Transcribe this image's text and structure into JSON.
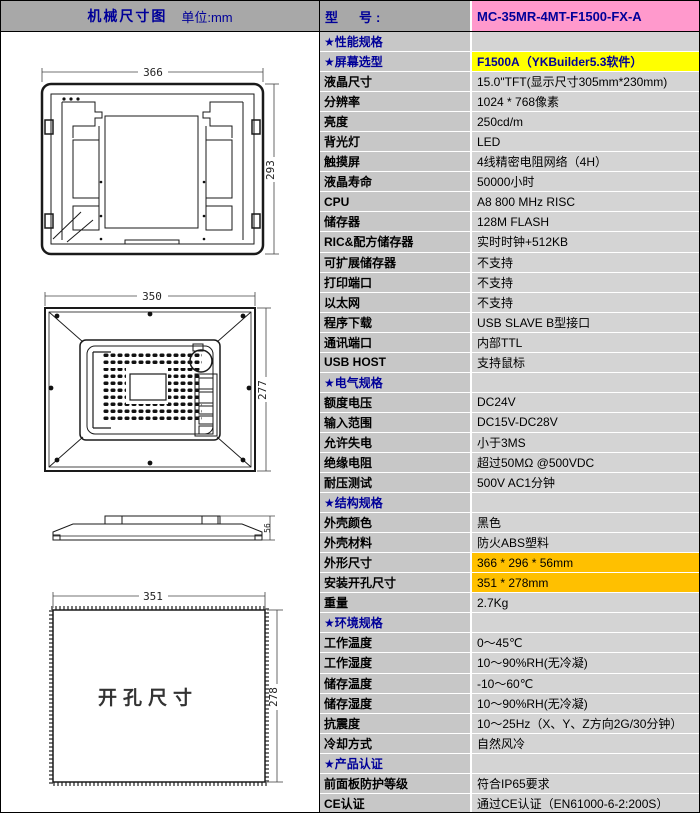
{
  "header": {
    "left_title": "机械尺寸图",
    "left_unit": "单位:mm",
    "model_label": "型　号:",
    "model_value": "MC-35MR-4MT-F1500-FX-A"
  },
  "drawings": {
    "front_view": {
      "width": "366",
      "height": "293"
    },
    "back_view": {
      "width": "350",
      "height": "277"
    },
    "side_view": {
      "depth": "56"
    },
    "cutout": {
      "width": "351",
      "height": "278",
      "label": "开孔尺寸"
    }
  },
  "colors": {
    "header_bg": "#a8a8a8",
    "model_bg": "#ff99cc",
    "label_bg": "#c7c7c7",
    "value_bg": "#d4d4d4",
    "highlight_yellow": "#ffff00",
    "highlight_orange": "#ffc000",
    "accent_blue": "#000099"
  },
  "table": {
    "rows": [
      {
        "type": "section",
        "label": "★性能规格",
        "value": ""
      },
      {
        "type": "yellow",
        "label": "★屏幕选型",
        "value": "F1500A（YKBuilder5.3软件）"
      },
      {
        "label": "液晶尺寸",
        "value": "15.0\"TFT(显示尺寸305mm*230mm)"
      },
      {
        "label": "分辨率",
        "value": "1024 * 768像素"
      },
      {
        "label": "亮度",
        "value": "250cd/m"
      },
      {
        "label": "背光灯",
        "value": "LED"
      },
      {
        "label": "触摸屏",
        "value": "4线精密电阻网络（4H）"
      },
      {
        "label": "液晶寿命",
        "value": "50000小时"
      },
      {
        "label": "CPU",
        "value": "A8 800 MHz RISC"
      },
      {
        "label": "储存器",
        "value": "128M FLASH"
      },
      {
        "label": "RIC&配方储存器",
        "value": "实时时钟+512KB"
      },
      {
        "label": "可扩展储存器",
        "value": "不支持"
      },
      {
        "label": "打印端口",
        "value": "不支持"
      },
      {
        "label": "以太网",
        "value": "不支持"
      },
      {
        "label": "程序下载",
        "value": "USB SLAVE B型接口"
      },
      {
        "label": "通讯端口",
        "value": "内部TTL"
      },
      {
        "label": "USB HOST",
        "value": "支持鼠标"
      },
      {
        "type": "section",
        "label": "★电气规格",
        "value": ""
      },
      {
        "label": "额度电压",
        "value": "DC24V"
      },
      {
        "label": "输入范围",
        "value": "DC15V-DC28V"
      },
      {
        "label": "允许失电",
        "value": "小于3MS"
      },
      {
        "label": "绝缘电阻",
        "value": "超过50MΩ @500VDC"
      },
      {
        "label": "耐压测试",
        "value": "500V AC1分钟"
      },
      {
        "type": "section",
        "label": "★结构规格",
        "value": ""
      },
      {
        "label": "外壳颜色",
        "value": "黑色"
      },
      {
        "label": "外壳材料",
        "value": "防火ABS塑料"
      },
      {
        "type": "orange",
        "label": "外形尺寸",
        "value": "366 * 296 * 56mm"
      },
      {
        "type": "orange",
        "label": "安装开孔尺寸",
        "value": "351 * 278mm"
      },
      {
        "label": "重量",
        "value": "2.7Kg"
      },
      {
        "type": "section",
        "label": "★环境规格",
        "value": ""
      },
      {
        "label": "工作温度",
        "value": "0～45℃"
      },
      {
        "label": "工作湿度",
        "value": "10～90%RH(无冷凝)"
      },
      {
        "label": "储存温度",
        "value": "-10～60℃"
      },
      {
        "label": "储存湿度",
        "value": "10～90%RH(无冷凝)"
      },
      {
        "label": "抗震度",
        "value": "10～25Hz（X、Y、Z方向2G/30分钟）"
      },
      {
        "label": "冷却方式",
        "value": "自然风冷"
      },
      {
        "type": "section",
        "label": "★产品认证",
        "value": ""
      },
      {
        "label": "前面板防护等级",
        "value": "符合IP65要求"
      },
      {
        "label": "CE认证",
        "value": "通过CE认证（EN61000-6-2:200S）"
      }
    ]
  }
}
